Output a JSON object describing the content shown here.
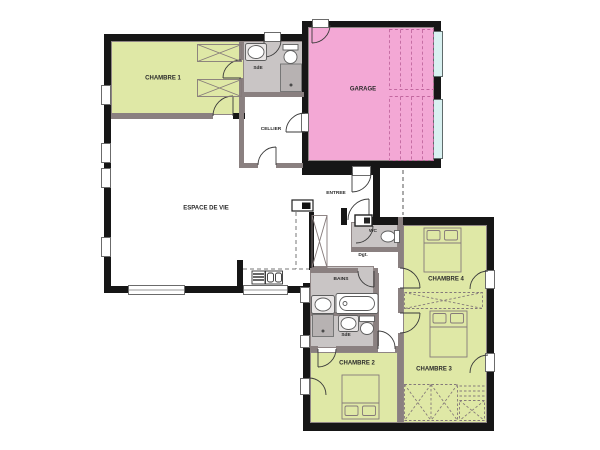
{
  "plan_title": "floor-plan",
  "rooms": {
    "chambre_1": {
      "label": "CHAMBRE 1"
    },
    "sde_1": {
      "label": "SdE"
    },
    "cellier": {
      "label": "CELLIER"
    },
    "garage": {
      "label": "GARAGE"
    },
    "espace_de_vie": {
      "label": "ESPACE DE VIE"
    },
    "entree": {
      "label": "ENTREE"
    },
    "wc": {
      "label": "WC"
    },
    "degagement": {
      "label": "Dgt."
    },
    "chambre_4": {
      "label": "CHAMBRE 4"
    },
    "bains": {
      "label": "BAINS"
    },
    "sde_2": {
      "label": "SdE"
    },
    "chambre_2": {
      "label": "CHAMBRE 2"
    },
    "chambre_3": {
      "label": "CHAMBRE 3"
    }
  },
  "colors": {
    "bedroom_fill": "#dfe8a6",
    "garage_fill": "#f3a8d5",
    "wet_room_fill": "#c9c5c5",
    "window_glass": "#d9f1f1",
    "wall": "#161616",
    "interior_wall": "#8a8080"
  }
}
